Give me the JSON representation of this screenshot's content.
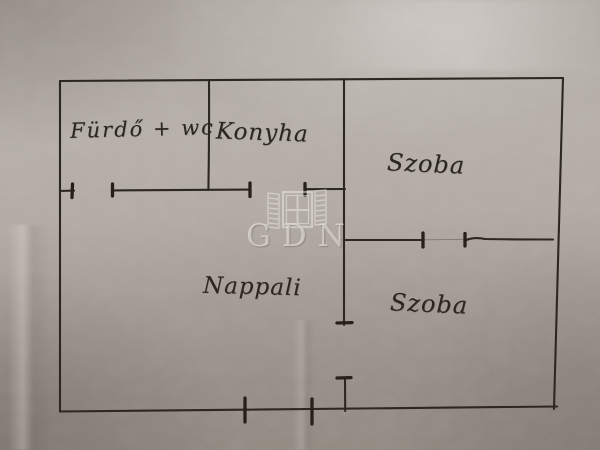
{
  "floorplan": {
    "rooms": [
      {
        "id": "furdo-wc",
        "label": "Fürdő + wc"
      },
      {
        "id": "konyha",
        "label": "Konyha"
      },
      {
        "id": "szoba-top",
        "label": "Szoba"
      },
      {
        "id": "nappali",
        "label": "Nappali"
      },
      {
        "id": "szoba-bottom",
        "label": "Szoba"
      }
    ],
    "watermark": {
      "text": "GDN",
      "logo_icon": "open-window-icon"
    },
    "colors": {
      "ink": "#2d2722",
      "tick_ink": "#262019",
      "paper_light": "#b7b0aa",
      "paper_dark": "#918880",
      "watermark": "#f0ece6"
    }
  }
}
